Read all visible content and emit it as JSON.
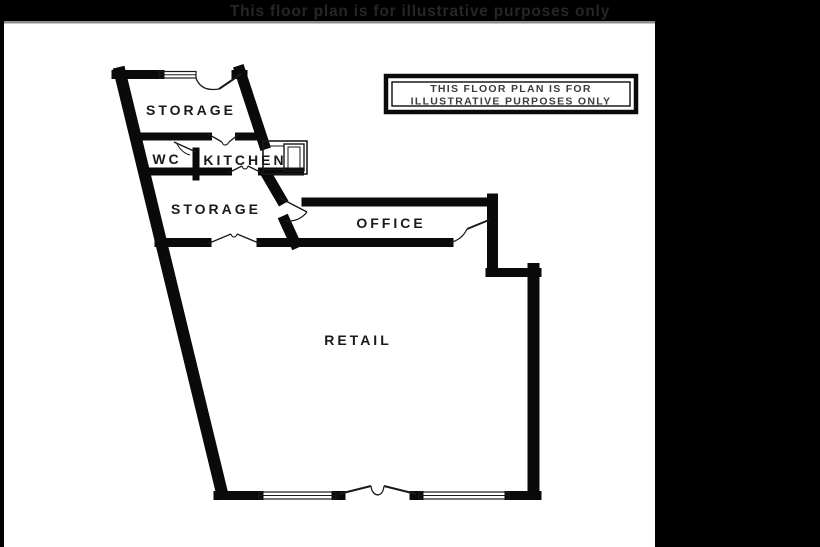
{
  "banner": {
    "title": "This floor plan is for illustrative purposes only"
  },
  "notice_box": {
    "line1": "THIS FLOOR PLAN IS FOR",
    "line2": "ILLUSTRATIVE PURPOSES ONLY"
  },
  "rooms": [
    {
      "name": "storage-top",
      "label": "STORAGE"
    },
    {
      "name": "wc",
      "label": "WC"
    },
    {
      "name": "kitchen",
      "label": "KITCHEN"
    },
    {
      "name": "storage-mid",
      "label": "STORAGE"
    },
    {
      "name": "office",
      "label": "OFFICE"
    },
    {
      "name": "retail",
      "label": "RETAIL"
    }
  ],
  "colors": {
    "wall": "#0a0a0a",
    "background": "#ffffff",
    "banner_bg": "#000000",
    "banner_text": "#262626",
    "divider_line": "#8c8c8c",
    "side_panel": "#000000",
    "left_border": "#000000",
    "notice_border": "#0a0a0a",
    "notice_text": "#3c3c3c"
  }
}
